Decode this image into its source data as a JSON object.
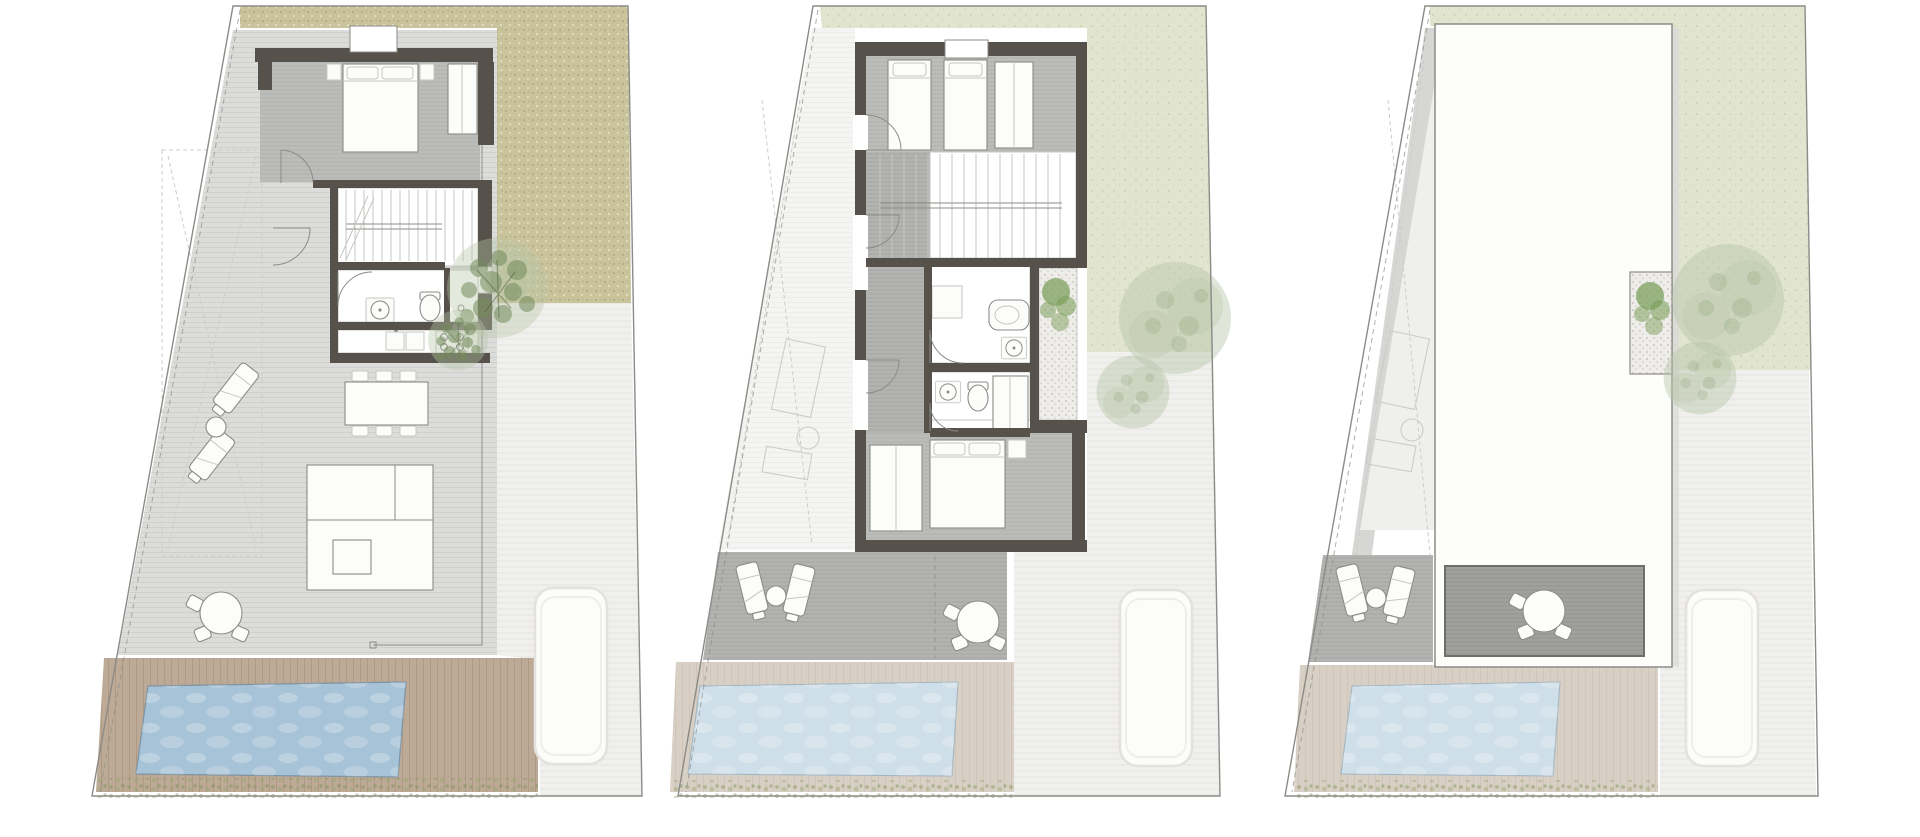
{
  "sheet": {
    "kind": "architectural-floor-plan-set",
    "sheets_count": 3,
    "plans": [
      {
        "name": "ground-floor",
        "features": [
          "entry-canopy",
          "double-bedroom",
          "staircase",
          "bathroom",
          "kitchen",
          "dining-table-six-chairs",
          "sectional-sofa",
          "covered-terrace",
          "two-sun-loungers",
          "round-outdoor-dining-table",
          "khaki-lawn-garden",
          "trees",
          "wood-pool-deck",
          "swimming-pool",
          "grass-verge",
          "driveway",
          "parked-car"
        ]
      },
      {
        "name": "upper-floor",
        "features": [
          "twin-bedroom",
          "staircase",
          "two-bathrooms",
          "gravel-lightwell-with-shrubs",
          "master-bedroom",
          "corridor",
          "roof-terrace-with-loungers",
          "round-dining-table",
          "ghost-outline-of-floor-below",
          "sage-lawn",
          "trees",
          "pale-pool-deck",
          "swimming-pool",
          "grass-verge",
          "driveway",
          "parked-car"
        ]
      },
      {
        "name": "roof",
        "features": [
          "roof-slab",
          "terrace-opening-with-dining-table",
          "gravel-patio-notch-with-shrub",
          "side-walkway",
          "ghost-outline-of-floor-below",
          "sun-loungers",
          "sage-lawn",
          "trees",
          "pale-pool-deck",
          "swimming-pool",
          "grass-verge",
          "driveway",
          "parked-car"
        ]
      }
    ]
  },
  "colors": {
    "paper": "#ffffff",
    "wall": "#56514a",
    "line_mid": "#8b8b87",
    "line_light": "#c6c6c2",
    "ghost": "#ccccc8",
    "floor_gray": "#bcbcba",
    "terrace_gray": "#dcdcda",
    "corridor_gray": "#b3b3b1",
    "deck_dark": "#a0a09e",
    "lawn_khaki": "#c9c49c",
    "lawn_sage": "#e1e4cf",
    "gravel": "#efede9",
    "wood_deck": "#bcaa96",
    "pale_deck": "#d9d0c5",
    "pool_blue": "#a7c3d7",
    "pool_pale": "#cfdfe9",
    "grass_green": "#94a66b",
    "tree_dark": "#748c5c",
    "tree_pale": "#b9c6a8",
    "bush_green": "#7da05e",
    "drive": "#f1f0ee",
    "car": "#fcfcfb"
  }
}
